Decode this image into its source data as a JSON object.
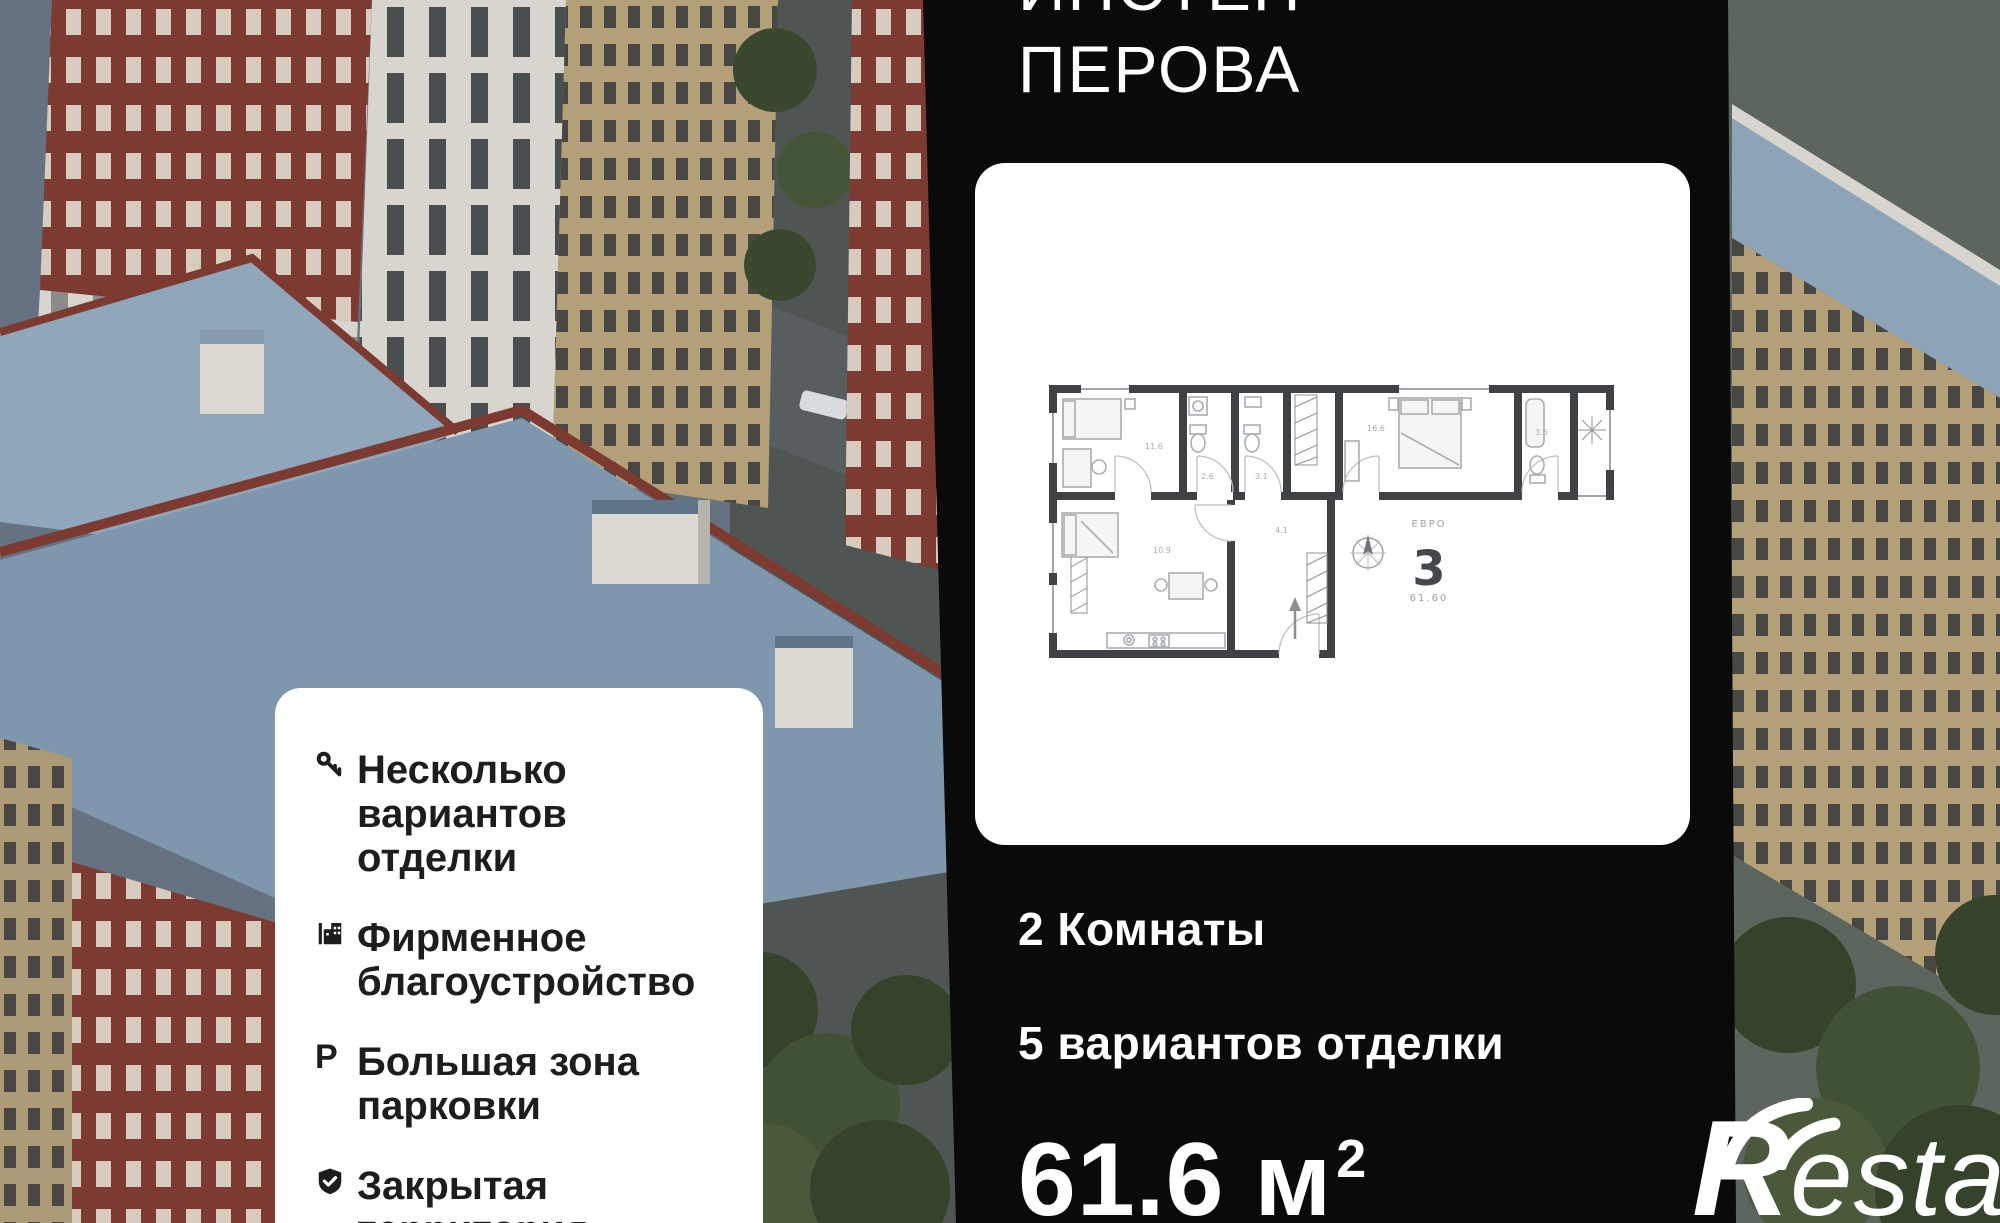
{
  "title": {
    "line1": "ИНСТЕП",
    "line2": "ПЕРОВА"
  },
  "floorplan_card": {
    "unit_type_label": "ЕВРО",
    "unit_number": "3",
    "unit_area": "61.60",
    "room_areas": [
      "11.6",
      "2.6",
      "3.1",
      "16.6",
      "3.6",
      "10.9",
      "4.1"
    ]
  },
  "specs": {
    "rooms": "2 Комнаты",
    "finishes": "5 вариантов отделки",
    "area_value": "61.6",
    "area_unit": "м",
    "area_exponent": "2"
  },
  "features": {
    "items": [
      {
        "icon": "key-icon",
        "text": "Несколько вариантов отделки"
      },
      {
        "icon": "building-icon",
        "text": "Фирменное благоустройство"
      },
      {
        "icon": "parking-icon",
        "letter": "P",
        "text": "Большая зона парковки"
      },
      {
        "icon": "shield-check-icon",
        "text": "Закрытая территория"
      }
    ]
  },
  "watermark": {
    "brand_initial": "R",
    "brand_suffix": "estate"
  },
  "colors": {
    "panel": "#0a0a0a",
    "card": "#ffffff",
    "text_on_panel": "#ffffff",
    "text_on_card": "#1d1d1d",
    "plan_wall": "#3f4245",
    "plan_furniture": "#a9aeb1",
    "plan_label": "#9aa0a4",
    "roof_blue": "#89a0b5",
    "brick_red": "#7c3a31",
    "facade_light": "#d8d5cf",
    "facade_tan": "#b3a078",
    "greenery": "#3a4830"
  }
}
